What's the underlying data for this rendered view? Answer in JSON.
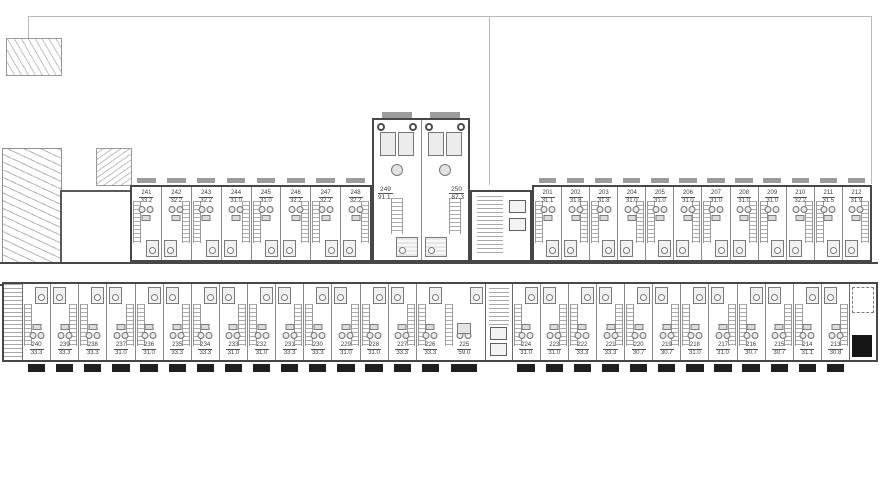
{
  "plan_name": "residential-floor-plan-level-2",
  "colors": {
    "wall": "#474747",
    "partition": "#8a8a8a",
    "stair_hatch": "#a8a8a8",
    "label_text": "#3c3c3c",
    "balcony_dark": "#1f1f1f",
    "balcony_gray": "#9c9c9c",
    "fixture_fill": "#ededed",
    "fixture_line": "#7a7a7a",
    "site_boundary": "#b9b9b9",
    "background": "#ffffff"
  },
  "units": {
    "top_left": [
      {
        "num": "241",
        "area": "33.2"
      },
      {
        "num": "242",
        "area": "32.2"
      },
      {
        "num": "243",
        "area": "32.2"
      },
      {
        "num": "244",
        "area": "31.0"
      },
      {
        "num": "245",
        "area": "31.0"
      },
      {
        "num": "246",
        "area": "32.2"
      },
      {
        "num": "247",
        "area": "32.2"
      },
      {
        "num": "248",
        "area": "32.2"
      }
    ],
    "top_center": [
      {
        "num": "249",
        "area": "91.1"
      },
      {
        "num": "250",
        "area": "87.3"
      }
    ],
    "top_right": [
      {
        "num": "201",
        "area": "31.1"
      },
      {
        "num": "202",
        "area": "31.8"
      },
      {
        "num": "203",
        "area": "31.8"
      },
      {
        "num": "204",
        "area": "31.0"
      },
      {
        "num": "205",
        "area": "31.0"
      },
      {
        "num": "206",
        "area": "31.0"
      },
      {
        "num": "207",
        "area": "31.0"
      },
      {
        "num": "208",
        "area": "31.0"
      },
      {
        "num": "209",
        "area": "31.0"
      },
      {
        "num": "210",
        "area": "32.2"
      },
      {
        "num": "211",
        "area": "31.5"
      },
      {
        "num": "212",
        "area": "31.9"
      }
    ],
    "bottom_left": [
      {
        "num": "240",
        "area": "33.3"
      },
      {
        "num": "239",
        "area": "33.3"
      },
      {
        "num": "238",
        "area": "33.3"
      },
      {
        "num": "237",
        "area": "31.0"
      },
      {
        "num": "236",
        "area": "31.0"
      },
      {
        "num": "235",
        "area": "33.3"
      },
      {
        "num": "234",
        "area": "33.3"
      },
      {
        "num": "233",
        "area": "31.0"
      },
      {
        "num": "232",
        "area": "31.0"
      },
      {
        "num": "231",
        "area": "33.3"
      },
      {
        "num": "230",
        "area": "33.3"
      },
      {
        "num": "229",
        "area": "31.0"
      },
      {
        "num": "228",
        "area": "31.0"
      },
      {
        "num": "227",
        "area": "33.3"
      },
      {
        "num": "226",
        "area": "33.3"
      }
    ],
    "bottom_core": [
      {
        "num": "225",
        "area": "59.0"
      }
    ],
    "bottom_right": [
      {
        "num": "224",
        "area": "31.0"
      },
      {
        "num": "223",
        "area": "31.0"
      },
      {
        "num": "222",
        "area": "33.3"
      },
      {
        "num": "221",
        "area": "33.3"
      },
      {
        "num": "220",
        "area": "30.7"
      },
      {
        "num": "219",
        "area": "30.7"
      },
      {
        "num": "218",
        "area": "31.0"
      },
      {
        "num": "217",
        "area": "31.0"
      },
      {
        "num": "216",
        "area": "30.7"
      },
      {
        "num": "215",
        "area": "30.7"
      },
      {
        "num": "214",
        "area": "31.1"
      },
      {
        "num": "213",
        "area": "30.8"
      }
    ]
  }
}
